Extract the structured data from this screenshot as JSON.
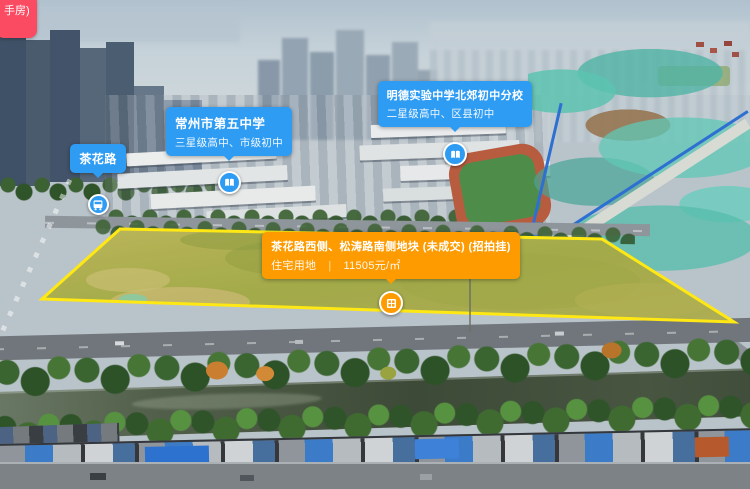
{
  "overlay": {
    "partial_button": {
      "label": "手房)"
    },
    "road_marker": {
      "label": "茶花路"
    },
    "school_markers": [
      {
        "name": "常州市第五中学",
        "grade": "三星级高中、市级初中"
      },
      {
        "name": "明德实验中学北郊初中分校",
        "grade": "二星级高中、区县初中"
      }
    ],
    "parcel_marker": {
      "title": "茶花路西侧、松涛路南侧地块 (未成交) (招拍挂)",
      "land_use": "住宅用地",
      "divider": "|",
      "price": "11505元/㎡"
    }
  },
  "colors": {
    "marker_blue": "#2f9cf4",
    "marker_orange": "#fd9b00",
    "parcel_outline": "#ffe813",
    "button_pink": "#fa4b63"
  }
}
